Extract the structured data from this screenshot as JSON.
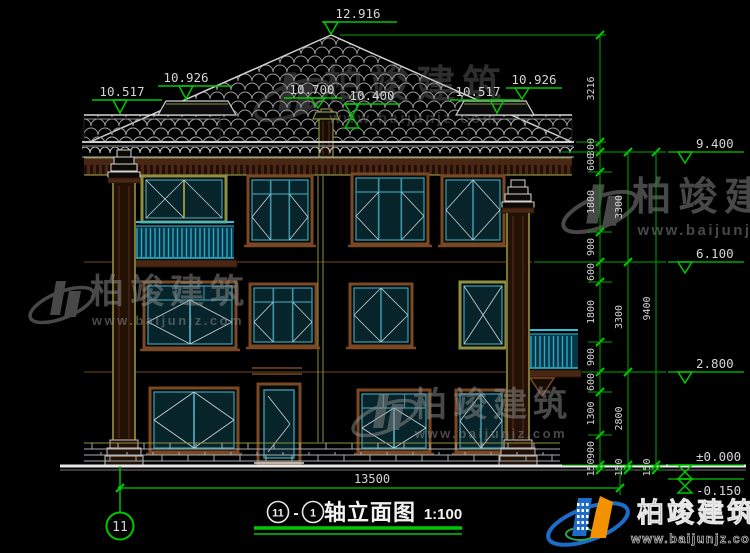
{
  "drawing_title": {
    "axis_from": "11",
    "dash": "-",
    "axis_to": "1",
    "name": "轴立面图",
    "scale": "1:100"
  },
  "axis_bubble": {
    "label": "11"
  },
  "overall_dimension": "13500",
  "elevation_labels": {
    "peak": "12.916",
    "left_upper": "10.926",
    "left_parapet": "10.517",
    "finial": "10.700",
    "ridge": "10.400",
    "right_parapet": "10.517",
    "right_upper": "10.926",
    "levels": [
      "9.400",
      "6.100",
      "2.800",
      "±0.000",
      "-0.150"
    ]
  },
  "dimension_chains": {
    "inner": [
      "3216",
      "300",
      "600",
      "1800",
      "900",
      "600",
      "1800",
      "900",
      "600",
      "1300",
      "900",
      "150"
    ],
    "middle": [
      "3300",
      "3300",
      "2800",
      "150"
    ],
    "outer": [
      "9400",
      "150"
    ]
  },
  "watermark": {
    "brand": "柏竣建筑",
    "url": "www.baijunjz.com"
  },
  "colors": {
    "dim_green": "#00c800",
    "cad_white": "#d8d8d8",
    "frame_brown": "#7a4822",
    "window_cyan": "#3f96a8",
    "railing_cyan": "#2fc0e0",
    "column_khaki": "#8f8f3f",
    "logo_blue": "#1e6bc8",
    "logo_orange": "#f39200"
  }
}
